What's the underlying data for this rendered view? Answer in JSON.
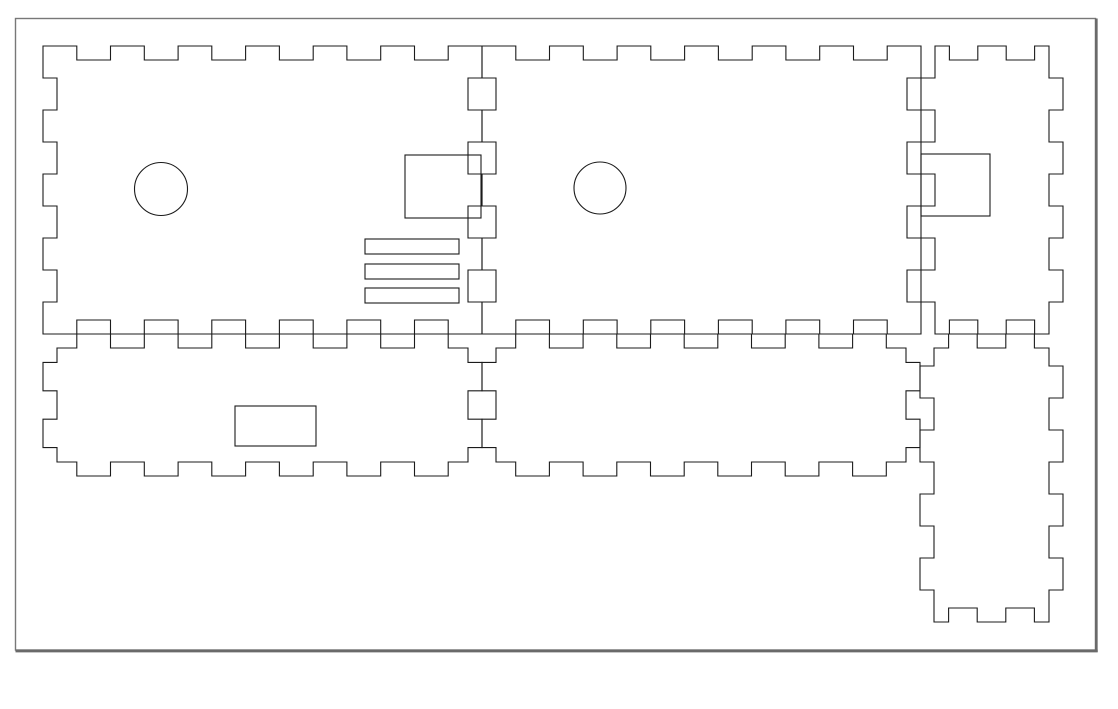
{
  "document": {
    "type": "laser-cut-panel-template",
    "background": "#ffffff",
    "canvas": {
      "width": 1118,
      "height": 709
    }
  },
  "sheet_border": {
    "x": 15.5,
    "y": 18.5,
    "width": 1080,
    "height": 631.5,
    "stroke_color": "#787878",
    "stroke_width": 1.4,
    "shadow_color": "#6a6a6a",
    "shadow_width": 2.7
  },
  "cut_style": {
    "stroke_color": "#1b1b1b",
    "stroke_width": 1.1,
    "notch_depth": 14
  },
  "panels": [
    {
      "name": "panel-top-left-side",
      "rect": [
        43,
        46,
        482,
        334
      ],
      "edges": {
        "top": {
          "n": 13,
          "parity": "odd"
        },
        "right": {
          "n": 9,
          "parity": "odd"
        },
        "bottom": {
          "n": 13,
          "parity": "odd"
        },
        "left": {
          "n": 9,
          "parity": "odd"
        }
      }
    },
    {
      "name": "panel-top-middle-side",
      "rect": [
        482,
        46,
        921,
        334
      ],
      "edges": {
        "top": {
          "n": 13,
          "parity": "odd"
        },
        "right": {
          "n": 9,
          "parity": "odd"
        },
        "bottom": {
          "n": 13,
          "parity": "odd"
        },
        "left": {
          "n": 9,
          "parity": "odd"
        }
      }
    },
    {
      "name": "panel-top-right-end",
      "rect": [
        921,
        46,
        1063,
        334
      ],
      "edges": {
        "top": {
          "n": 5,
          "parity": "odd"
        },
        "right": {
          "n": 9,
          "parity": "even"
        },
        "bottom": {
          "n": 5,
          "parity": "odd"
        },
        "left": {
          "n": 9,
          "parity": "even"
        }
      }
    },
    {
      "name": "panel-bottom-left-rail",
      "rect": [
        43,
        334,
        482,
        476
      ],
      "edges": {
        "top": {
          "n": 13,
          "parity": "even"
        },
        "right": {
          "n": 5,
          "parity": "even"
        },
        "bottom": {
          "n": 13,
          "parity": "even"
        },
        "left": {
          "n": 5,
          "parity": "even"
        }
      }
    },
    {
      "name": "panel-bottom-middle-rail",
      "rect": [
        482,
        334,
        920,
        476
      ],
      "edges": {
        "top": {
          "n": 13,
          "parity": "even"
        },
        "right": {
          "n": 5,
          "parity": "even"
        },
        "bottom": {
          "n": 13,
          "parity": "even"
        },
        "left": {
          "n": 5,
          "parity": "even"
        }
      }
    },
    {
      "name": "panel-bottom-right-end",
      "rect": [
        920,
        334,
        1063,
        622
      ],
      "edges": {
        "top": {
          "n": 5,
          "parity": "even"
        },
        "right": {
          "n": 9,
          "parity": "even"
        },
        "bottom": {
          "n": 5,
          "parity": "odd"
        },
        "left": {
          "n": 9,
          "parity": "even"
        }
      }
    }
  ],
  "holes": [
    {
      "name": "circle-hole-left-panel",
      "type": "circle",
      "cx": 161,
      "cy": 189,
      "r": 26.5
    },
    {
      "name": "circle-hole-middle-panel",
      "type": "circle",
      "cx": 600,
      "cy": 188,
      "r": 26
    },
    {
      "name": "square-hole-left-panel",
      "type": "rect",
      "x": 405,
      "y": 155,
      "w": 76,
      "h": 63
    },
    {
      "name": "square-hole-right-panel",
      "type": "rect",
      "x": 921,
      "y": 154,
      "w": 69,
      "h": 62
    },
    {
      "name": "vent-slot-1",
      "type": "rect",
      "x": 365,
      "y": 239,
      "w": 94,
      "h": 15
    },
    {
      "name": "vent-slot-2",
      "type": "rect",
      "x": 365,
      "y": 264,
      "w": 94,
      "h": 15
    },
    {
      "name": "vent-slot-3",
      "type": "rect",
      "x": 365,
      "y": 288,
      "w": 94,
      "h": 15
    },
    {
      "name": "rect-hole-bottom-left-rail",
      "type": "rect",
      "x": 235,
      "y": 406,
      "w": 81,
      "h": 40
    }
  ]
}
